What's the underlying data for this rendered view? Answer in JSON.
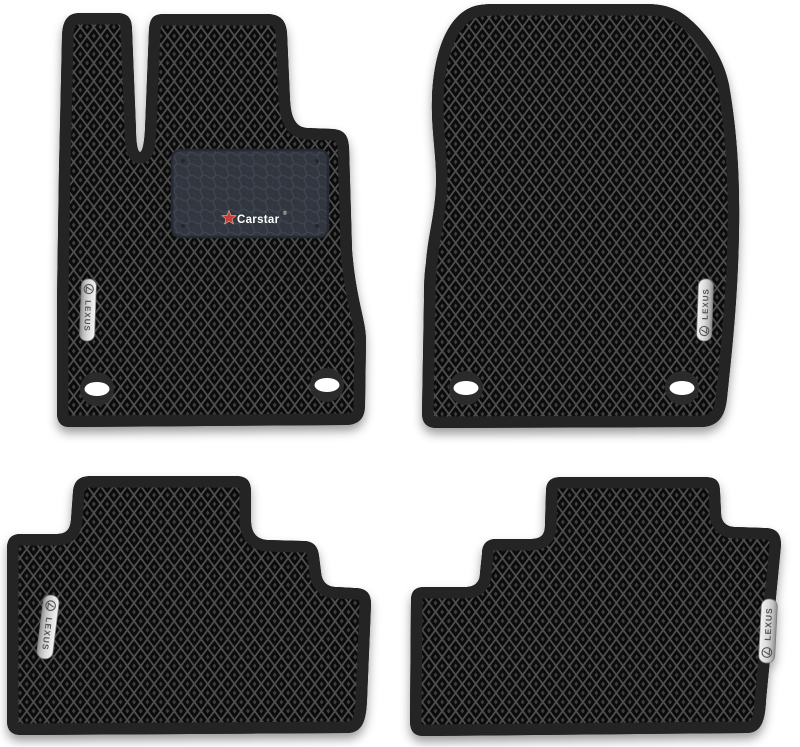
{
  "image": {
    "type": "product-photo",
    "description": "Set of four black EVA car floor mats with diamond (rhombus) pattern for a Lexus: two front mats with fastening holes and two rear mats with step cutouts",
    "background": "#ffffff"
  },
  "colors": {
    "mat_border": "#242424",
    "diamond_cell": "#0b0b0b",
    "diamond_grid": "#4f4f4f",
    "diamond_dot": "#3e3e3e",
    "patch_bg": "#31363f",
    "patch_hex_line": "#3f4550",
    "patch_edge": "#262b33",
    "badge_silver_light": "#f4f4f4",
    "badge_silver_dark": "#8f8f8f",
    "badge_text": "#50545a",
    "carstar_red": "#cd3c30",
    "carstar_text": "#ffffff",
    "hole_ring": "#2b2b2b",
    "hole_fill": "#ffffff"
  },
  "badges": {
    "lexus_label": "LEXUS",
    "lexus_logo_icon": "lexus-l-in-circle"
  },
  "patch": {
    "brand_label": "Carstar",
    "reg_mark": "®",
    "star_icon": "red-five-point-star",
    "texture": "honeycomb"
  },
  "mats": [
    {
      "id": "front-left",
      "name": "Driver front mat",
      "badge": "LEXUS",
      "holes": 2,
      "heel_pad": true
    },
    {
      "id": "front-right",
      "name": "Passenger front mat",
      "badge": "LEXUS",
      "holes": 2,
      "heel_pad": false
    },
    {
      "id": "rear-left",
      "name": "Rear left mat",
      "badge": "LEXUS",
      "holes": 0,
      "heel_pad": false
    },
    {
      "id": "rear-right",
      "name": "Rear right mat",
      "badge": "LEXUS",
      "holes": 0,
      "heel_pad": false
    }
  ]
}
